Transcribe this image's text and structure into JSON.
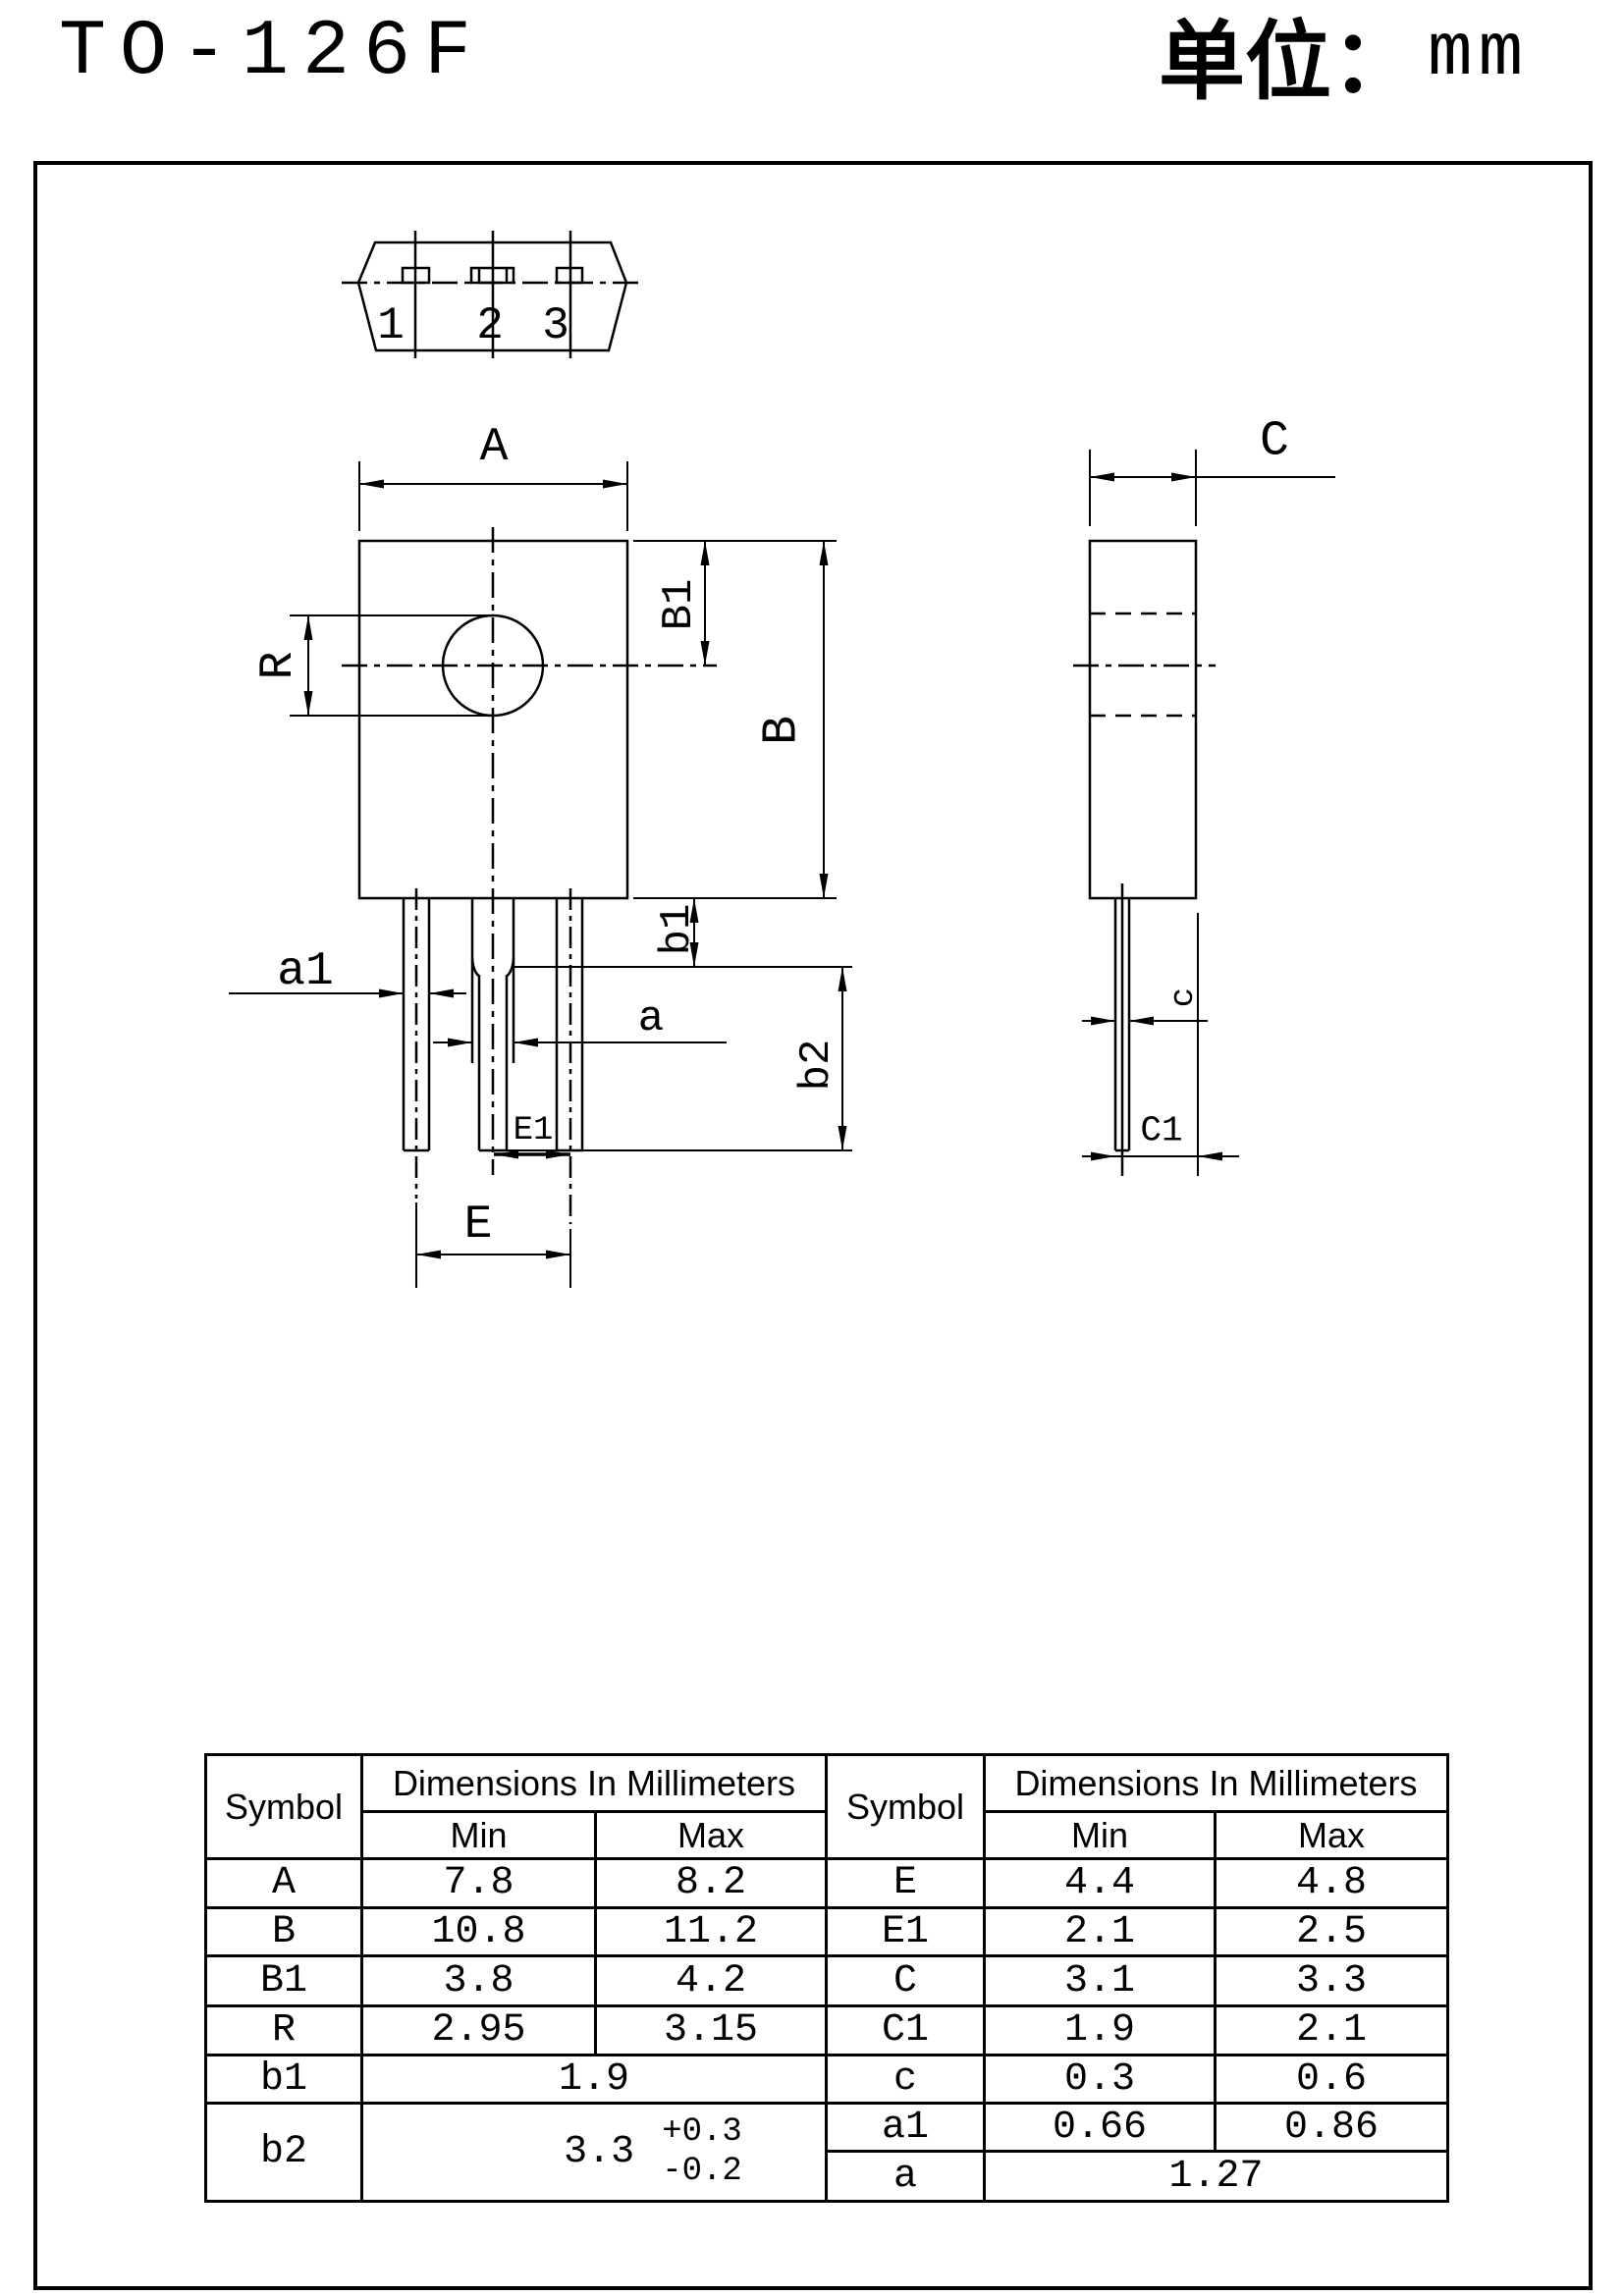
{
  "page": {
    "title": "TO-126F",
    "unit_label": "单位：",
    "unit_value": "mm"
  },
  "drawing": {
    "pins": [
      "1",
      "2",
      "3"
    ],
    "labels": {
      "A": "A",
      "B": "B",
      "B1": "B1",
      "R": "R",
      "a1": "a1",
      "a": "a",
      "b1": "b1",
      "b2": "b2",
      "E": "E",
      "E1": "E1",
      "C": "C",
      "C1": "C1",
      "c": "c"
    }
  },
  "table": {
    "header": {
      "symbol": "Symbol",
      "dims": "Dimensions In Millimeters",
      "min": "Min",
      "max": "Max"
    },
    "left_rows": [
      {
        "symbol": "A",
        "min": "7.8",
        "max": "8.2"
      },
      {
        "symbol": "B",
        "min": "10.8",
        "max": "11.2"
      },
      {
        "symbol": "B1",
        "min": "3.8",
        "max": "4.2"
      },
      {
        "symbol": "R",
        "min": "2.95",
        "max": "3.15"
      }
    ],
    "b1_row": {
      "symbol": "b1",
      "value": "1.9"
    },
    "b2_row": {
      "symbol": "b2",
      "value": "3.3",
      "tol_plus": "+0.3",
      "tol_minus": "-0.2"
    },
    "right_rows": [
      {
        "symbol": "E",
        "min": "4.4",
        "max": "4.8"
      },
      {
        "symbol": "E1",
        "min": "2.1",
        "max": "2.5"
      },
      {
        "symbol": "C",
        "min": "3.1",
        "max": "3.3"
      },
      {
        "symbol": "C1",
        "min": "1.9",
        "max": "2.1"
      },
      {
        "symbol": "c",
        "min": "0.3",
        "max": "0.6"
      },
      {
        "symbol": "a1",
        "min": "0.66",
        "max": "0.86"
      }
    ],
    "a_row": {
      "symbol": "a",
      "value": "1.27"
    }
  }
}
